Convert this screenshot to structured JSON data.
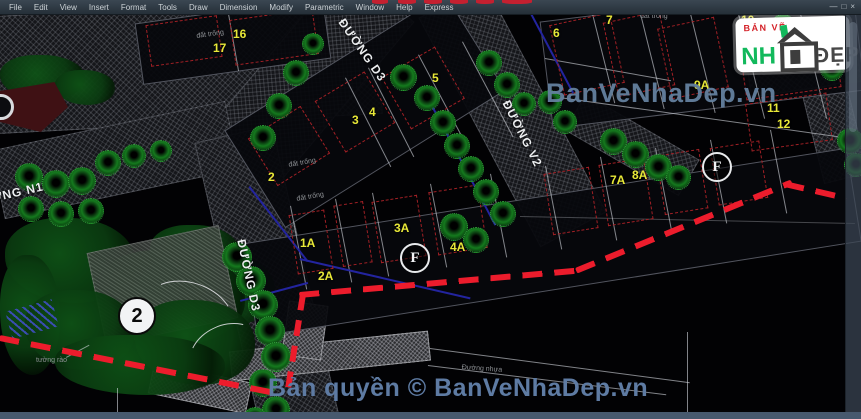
{
  "window": {
    "menu_items": [
      "File",
      "Edit",
      "View",
      "Insert",
      "Format",
      "Tools",
      "Draw",
      "Dimension",
      "Modify",
      "Parametric",
      "Window",
      "Help",
      "Express"
    ],
    "controls": [
      {
        "glyph": "—",
        "name": "minimize-button"
      },
      {
        "glyph": "□",
        "name": "restore-button"
      },
      {
        "glyph": "×",
        "name": "close-button"
      }
    ]
  },
  "logo": {
    "top": "BẢN VẼ",
    "nh": "NH",
    "dep": "ĐẸP"
  },
  "watermarks": {
    "center": "BanVeNhaDep.vn",
    "bottom": "Bản quyền © BanVeNhaDep.vn"
  },
  "colors": {
    "boundary_red": "#ec1c2c",
    "lot_label_yellow": "#e8e838",
    "tree_green": "#157a1e",
    "watermark_blue": "#64819f",
    "logo_green": "#12b95c",
    "logo_red": "#d42027",
    "menu_bg": "#2f3a44",
    "bottom_strip": "#47596e"
  },
  "scene": {
    "elements": [
      {
        "cls": "road",
        "x": -5,
        "y": 6,
        "w": 385,
        "h": 118,
        "rot": -3
      },
      {
        "cls": "road",
        "x": 258,
        "y": -35,
        "w": 90,
        "h": 240,
        "rot": 40
      },
      {
        "cls": "road",
        "x": -5,
        "y": 125,
        "w": 240,
        "h": 70,
        "rot": -12
      },
      {
        "cls": "road",
        "x": 227,
        "y": 130,
        "w": 80,
        "h": 300,
        "rot": -13
      },
      {
        "cls": "road",
        "x": 475,
        "y": -15,
        "w": 75,
        "h": 260,
        "rot": -28
      },
      {
        "cls": "road",
        "x": 745,
        "y": 12,
        "w": 112,
        "h": 78,
        "rot": -8
      },
      {
        "cls": "road",
        "x": 812,
        "y": 85,
        "w": 46,
        "h": 95,
        "rot": -14
      },
      {
        "cls": "road",
        "x": 566,
        "y": 124,
        "w": 132,
        "h": 42,
        "rot": 30
      },
      {
        "cls": "roadlight",
        "x": 230,
        "y": 341,
        "w": 200,
        "h": 30,
        "rot": -6
      },
      {
        "cls": "roadlight",
        "x": 285,
        "y": 303,
        "w": 40,
        "h": 55,
        "rot": 8
      },
      {
        "cls": "roadlight",
        "x": 150,
        "y": 372,
        "w": 100,
        "h": 32,
        "rot": 12
      },
      {
        "cls": "blob",
        "x": 5,
        "y": 218,
        "w": 130,
        "h": 85
      },
      {
        "cls": "blob",
        "x": 150,
        "y": 225,
        "w": 90,
        "h": 55
      },
      {
        "cls": "blob",
        "x": 185,
        "y": 255,
        "w": 90,
        "h": 70
      },
      {
        "cls": "blob",
        "x": 0,
        "y": 255,
        "w": 60,
        "h": 120
      },
      {
        "cls": "blob",
        "x": 95,
        "y": 250,
        "w": 150,
        "h": 95
      },
      {
        "cls": "blob",
        "x": 0,
        "y": 55,
        "w": 85,
        "h": 45
      },
      {
        "cls": "blob",
        "x": 55,
        "y": 70,
        "w": 60,
        "h": 35
      },
      {
        "cls": "patch",
        "x": 95,
        "y": 238,
        "w": 135,
        "h": 95,
        "rot": -12
      },
      {
        "cls": "blob",
        "x": 25,
        "y": 290,
        "w": 110,
        "h": 80
      },
      {
        "cls": "blob",
        "x": 135,
        "y": 300,
        "w": 120,
        "h": 85
      },
      {
        "cls": "blob",
        "x": 55,
        "y": 335,
        "w": 170,
        "h": 60
      },
      {
        "cls": "stripes",
        "x": 8,
        "y": 305,
        "w": 48,
        "h": 28,
        "rot": -15
      },
      {
        "cls": "arc",
        "x": 140,
        "y": 282,
        "w": 95,
        "h": 70,
        "rot": 18
      },
      {
        "cls": "arc",
        "x": 188,
        "y": 325,
        "w": 75,
        "h": 55,
        "rot": -25
      },
      {
        "cls": "wedge",
        "x": 0,
        "y": 82,
        "w": 68,
        "h": 50
      },
      {
        "cls": "circ",
        "x": -12,
        "y": 94,
        "d": 26
      },
      {
        "cls": "lot",
        "x": 138,
        "y": 10,
        "w": 190,
        "h": 62,
        "rot": -8
      },
      {
        "cls": "lot",
        "x": 235,
        "y": 53,
        "w": 260,
        "h": 115,
        "rot": -32
      },
      {
        "cls": "lot",
        "x": 545,
        "y": 2,
        "w": 315,
        "h": 108,
        "rot": -7
      },
      {
        "cls": "lot",
        "x": 246,
        "y": 195,
        "w": 612,
        "h": 95,
        "rot": -9
      },
      {
        "cls": "line",
        "x": 228,
        "y": 14,
        "w": 1,
        "h": 58,
        "rot": -10
      },
      {
        "cls": "line",
        "x": 345,
        "y": 78,
        "w": 1,
        "h": 100,
        "rot": -27
      },
      {
        "cls": "line",
        "x": 368,
        "y": 68,
        "w": 1,
        "h": 100,
        "rot": -27
      },
      {
        "cls": "line",
        "x": 418,
        "y": 55,
        "w": 1,
        "h": 105,
        "rot": -28
      },
      {
        "cls": "line",
        "x": 462,
        "y": 42,
        "w": 1,
        "h": 108,
        "rot": -28
      },
      {
        "cls": "line",
        "x": 592,
        "y": 14,
        "w": 1,
        "h": 92,
        "rot": -14
      },
      {
        "cls": "line",
        "x": 640,
        "y": 14,
        "w": 1,
        "h": 98,
        "rot": -14
      },
      {
        "cls": "line",
        "x": 690,
        "y": 14,
        "w": 1,
        "h": 102,
        "rot": -14
      },
      {
        "cls": "line",
        "x": 738,
        "y": 14,
        "w": 1,
        "h": 108,
        "rot": -14
      },
      {
        "cls": "line",
        "x": 800,
        "y": 14,
        "w": 1,
        "h": 108,
        "rot": -14
      },
      {
        "cls": "line",
        "x": 552,
        "y": 96,
        "w": 308,
        "h": 1,
        "rot": 8
      },
      {
        "cls": "line",
        "x": 545,
        "y": 58,
        "w": 128,
        "h": 1,
        "rot": 10
      },
      {
        "cls": "line",
        "x": 290,
        "y": 206,
        "w": 1,
        "h": 85,
        "rot": -11
      },
      {
        "cls": "line",
        "x": 335,
        "y": 199,
        "w": 1,
        "h": 85,
        "rot": -11
      },
      {
        "cls": "line",
        "x": 372,
        "y": 193,
        "w": 1,
        "h": 85,
        "rot": -11
      },
      {
        "cls": "line",
        "x": 430,
        "y": 184,
        "w": 1,
        "h": 85,
        "rot": -11
      },
      {
        "cls": "line",
        "x": 490,
        "y": 174,
        "w": 1,
        "h": 85,
        "rot": -11
      },
      {
        "cls": "line",
        "x": 545,
        "y": 166,
        "w": 1,
        "h": 85,
        "rot": -11
      },
      {
        "cls": "line",
        "x": 600,
        "y": 157,
        "w": 1,
        "h": 85,
        "rot": -11
      },
      {
        "cls": "line",
        "x": 655,
        "y": 148,
        "w": 1,
        "h": 85,
        "rot": -11
      },
      {
        "cls": "line",
        "x": 710,
        "y": 140,
        "w": 1,
        "h": 85,
        "rot": -11
      },
      {
        "cls": "line",
        "x": 770,
        "y": 130,
        "w": 1,
        "h": 85,
        "rot": -11
      },
      {
        "cls": "line",
        "x": 430,
        "y": 348,
        "w": 262,
        "h": 1,
        "rot": 7.5
      },
      {
        "cls": "line",
        "x": 428,
        "y": 365,
        "w": 240,
        "h": 1,
        "rot": 7
      },
      {
        "cls": "line",
        "x": 117,
        "y": 388,
        "w": 1,
        "h": 31
      },
      {
        "cls": "line",
        "x": 687,
        "y": 332,
        "w": 1,
        "h": 82
      },
      {
        "cls": "fline",
        "x": 520,
        "y": 216,
        "w": 335,
        "h": 1,
        "rot": 1.2
      },
      {
        "cls": "line",
        "x": 66,
        "y": 357,
        "w": 26,
        "h": 1,
        "rot": -28
      },
      {
        "cls": "bline",
        "x": 250,
        "y": 186,
        "w": 95,
        "h": 2,
        "rot": 52
      },
      {
        "cls": "bline",
        "x": 300,
        "y": 258,
        "w": 175,
        "h": 2,
        "rot": 13
      },
      {
        "cls": "bline",
        "x": 425,
        "y": 95,
        "w": 2,
        "h": 148,
        "rot": -28
      },
      {
        "cls": "bline",
        "x": 530,
        "y": 14,
        "w": 2,
        "h": 90,
        "rot": -28
      },
      {
        "cls": "bline",
        "x": 240,
        "y": 300,
        "w": 70,
        "h": 2,
        "rot": -15
      },
      {
        "cls": "rd",
        "x": 148,
        "y": 20,
        "w": 72,
        "h": 42,
        "rot": -8
      },
      {
        "cls": "rd",
        "x": 232,
        "y": 14,
        "w": 84,
        "h": 46,
        "rot": -8
      },
      {
        "cls": "rd",
        "x": 258,
        "y": 118,
        "w": 62,
        "h": 56,
        "rot": -32
      },
      {
        "cls": "rd",
        "x": 326,
        "y": 82,
        "w": 58,
        "h": 60,
        "rot": -31
      },
      {
        "cls": "rd",
        "x": 392,
        "y": 58,
        "w": 62,
        "h": 60,
        "rot": -30
      },
      {
        "cls": "rd",
        "x": 556,
        "y": 18,
        "w": 62,
        "h": 72,
        "rot": -12
      },
      {
        "cls": "rd",
        "x": 610,
        "y": 16,
        "w": 58,
        "h": 76,
        "rot": -12
      },
      {
        "cls": "rd",
        "x": 664,
        "y": 22,
        "w": 58,
        "h": 72,
        "rot": -12
      },
      {
        "cls": "rd",
        "x": 742,
        "y": 36,
        "w": 96,
        "h": 58,
        "rot": -8
      },
      {
        "cls": "rd",
        "x": 748,
        "y": 98,
        "w": 82,
        "h": 48,
        "rot": -8
      },
      {
        "cls": "rd",
        "x": 293,
        "y": 212,
        "w": 36,
        "h": 60,
        "rot": -9
      },
      {
        "cls": "rd",
        "x": 338,
        "y": 203,
        "w": 30,
        "h": 62,
        "rot": -9
      },
      {
        "cls": "rd",
        "x": 376,
        "y": 198,
        "w": 46,
        "h": 62,
        "rot": -9
      },
      {
        "cls": "rd",
        "x": 433,
        "y": 188,
        "w": 50,
        "h": 64,
        "rot": -9
      },
      {
        "cls": "rd",
        "x": 548,
        "y": 170,
        "w": 46,
        "h": 62,
        "rot": -9
      },
      {
        "cls": "rd",
        "x": 603,
        "y": 161,
        "w": 46,
        "h": 62,
        "rot": -9
      },
      {
        "cls": "rd",
        "x": 660,
        "y": 152,
        "w": 44,
        "h": 60,
        "rot": -9
      },
      {
        "cls": "rd",
        "x": 714,
        "y": 144,
        "w": 50,
        "h": 58,
        "rot": -9
      },
      {
        "cls": "tree",
        "x": 283,
        "y": 60,
        "d": 26
      },
      {
        "cls": "tree",
        "x": 266,
        "y": 93,
        "d": 26
      },
      {
        "cls": "tree",
        "x": 250,
        "y": 125,
        "d": 26
      },
      {
        "cls": "tree",
        "x": 302,
        "y": 33,
        "d": 22
      },
      {
        "cls": "tree",
        "x": 390,
        "y": 64,
        "d": 27
      },
      {
        "cls": "tree",
        "x": 414,
        "y": 85,
        "d": 26
      },
      {
        "cls": "tree",
        "x": 430,
        "y": 110,
        "d": 26
      },
      {
        "cls": "tree",
        "x": 444,
        "y": 133,
        "d": 26
      },
      {
        "cls": "tree",
        "x": 458,
        "y": 156,
        "d": 26
      },
      {
        "cls": "tree",
        "x": 473,
        "y": 179,
        "d": 26
      },
      {
        "cls": "tree",
        "x": 490,
        "y": 201,
        "d": 26
      },
      {
        "cls": "tree",
        "x": 440,
        "y": 213,
        "d": 28
      },
      {
        "cls": "tree",
        "x": 463,
        "y": 227,
        "d": 26
      },
      {
        "cls": "tree",
        "x": 476,
        "y": 50,
        "d": 26
      },
      {
        "cls": "tree",
        "x": 494,
        "y": 72,
        "d": 26
      },
      {
        "cls": "tree",
        "x": 512,
        "y": 92,
        "d": 24
      },
      {
        "cls": "tree",
        "x": 538,
        "y": 90,
        "d": 24
      },
      {
        "cls": "tree",
        "x": 553,
        "y": 110,
        "d": 24
      },
      {
        "cls": "tree",
        "x": 600,
        "y": 128,
        "d": 27
      },
      {
        "cls": "tree",
        "x": 622,
        "y": 141,
        "d": 27
      },
      {
        "cls": "tree",
        "x": 645,
        "y": 154,
        "d": 27
      },
      {
        "cls": "tree",
        "x": 666,
        "y": 165,
        "d": 25
      },
      {
        "cls": "tree",
        "x": 770,
        "y": 14,
        "d": 26
      },
      {
        "cls": "tree",
        "x": 796,
        "y": 37,
        "d": 26
      },
      {
        "cls": "tree",
        "x": 820,
        "y": 57,
        "d": 24
      },
      {
        "cls": "tree",
        "x": 837,
        "y": 128,
        "d": 26
      },
      {
        "cls": "tree",
        "x": 844,
        "y": 153,
        "d": 24
      },
      {
        "cls": "tree",
        "x": 15,
        "y": 163,
        "d": 28
      },
      {
        "cls": "tree",
        "x": 42,
        "y": 170,
        "d": 28
      },
      {
        "cls": "tree",
        "x": 68,
        "y": 167,
        "d": 28
      },
      {
        "cls": "tree",
        "x": 95,
        "y": 150,
        "d": 26
      },
      {
        "cls": "tree",
        "x": 122,
        "y": 144,
        "d": 24
      },
      {
        "cls": "tree",
        "x": 150,
        "y": 140,
        "d": 22
      },
      {
        "cls": "tree",
        "x": 18,
        "y": 196,
        "d": 26
      },
      {
        "cls": "tree",
        "x": 48,
        "y": 201,
        "d": 26
      },
      {
        "cls": "tree",
        "x": 78,
        "y": 198,
        "d": 26
      },
      {
        "cls": "tree",
        "x": 222,
        "y": 242,
        "d": 30
      },
      {
        "cls": "tree",
        "x": 236,
        "y": 266,
        "d": 30
      },
      {
        "cls": "tree",
        "x": 248,
        "y": 290,
        "d": 30
      },
      {
        "cls": "tree",
        "x": 255,
        "y": 316,
        "d": 30
      },
      {
        "cls": "tree",
        "x": 261,
        "y": 342,
        "d": 30
      },
      {
        "cls": "tree",
        "x": 249,
        "y": 369,
        "d": 28
      },
      {
        "cls": "tree",
        "x": 262,
        "y": 396,
        "d": 28
      },
      {
        "cls": "tree",
        "x": 243,
        "y": 407,
        "d": 24
      },
      {
        "cls": "rdash",
        "x": 0,
        "y": 335,
        "w": 282,
        "h": 6,
        "rot": 11.3
      },
      {
        "cls": "rdashv",
        "x": 300,
        "y": 294,
        "w": 6,
        "h": 100,
        "rot": 9
      },
      {
        "cls": "rdash",
        "x": 299,
        "y": 292,
        "w": 280,
        "h": 6,
        "rot": -5
      },
      {
        "cls": "rdash",
        "x": 575,
        "y": 268,
        "w": 233,
        "h": 6,
        "rot": -22.3
      },
      {
        "cls": "rdash",
        "x": 785,
        "y": 181,
        "w": 64,
        "h": 6,
        "rot": 13
      },
      {
        "cls": "redfrag",
        "x": 372,
        "y": 0,
        "w": 16,
        "h": 4
      },
      {
        "cls": "redfrag",
        "x": 398,
        "y": 0,
        "w": 18,
        "h": 4
      },
      {
        "cls": "redfrag",
        "x": 424,
        "y": 0,
        "w": 18,
        "h": 4
      },
      {
        "cls": "redfrag",
        "x": 450,
        "y": 0,
        "w": 18,
        "h": 4
      },
      {
        "cls": "redfrag",
        "x": 476,
        "y": 0,
        "w": 18,
        "h": 4
      },
      {
        "cls": "redfrag",
        "x": 502,
        "y": 0,
        "w": 30,
        "h": 4
      },
      {
        "cls": "street",
        "text": "ĐƯỜNG D3",
        "x": 347,
        "y": 16,
        "rot": 55
      },
      {
        "cls": "street",
        "text": "ĐƯỜNG N1",
        "x": -30,
        "y": 196,
        "rot": -13
      },
      {
        "cls": "street",
        "text": "ĐƯỜNG V2",
        "x": 512,
        "y": 98,
        "rot": 63
      },
      {
        "cls": "street",
        "text": "ĐƯỜNG D3",
        "x": 248,
        "y": 238,
        "rot": 78
      },
      {
        "cls": "lotnum",
        "text": "17",
        "x": 213,
        "y": 41
      },
      {
        "cls": "lotnum",
        "text": "16",
        "x": 233,
        "y": 27
      },
      {
        "cls": "lotnum",
        "text": "2",
        "x": 268,
        "y": 170
      },
      {
        "cls": "lotnum",
        "text": "3",
        "x": 352,
        "y": 113
      },
      {
        "cls": "lotnum",
        "text": "4",
        "x": 369,
        "y": 105
      },
      {
        "cls": "lotnum",
        "text": "5",
        "x": 432,
        "y": 71
      },
      {
        "cls": "lotnum",
        "text": "6",
        "x": 553,
        "y": 26
      },
      {
        "cls": "lotnum",
        "text": "7",
        "x": 606,
        "y": 13
      },
      {
        "cls": "lotnum",
        "text": "10",
        "x": 741,
        "y": 13
      },
      {
        "cls": "lotnum",
        "text": "9A",
        "x": 694,
        "y": 78
      },
      {
        "cls": "lotnum",
        "text": "11",
        "x": 767,
        "y": 101
      },
      {
        "cls": "lotnum",
        "text": "12",
        "x": 777,
        "y": 117
      },
      {
        "cls": "lotnum",
        "text": "1A",
        "x": 300,
        "y": 236
      },
      {
        "cls": "lotnum",
        "text": "2A",
        "x": 318,
        "y": 269
      },
      {
        "cls": "lotnum",
        "text": "3A",
        "x": 394,
        "y": 221
      },
      {
        "cls": "lotnum",
        "text": "4A",
        "x": 450,
        "y": 240
      },
      {
        "cls": "lotnum",
        "text": "7A",
        "x": 610,
        "y": 173
      },
      {
        "cls": "lotnum",
        "text": "8A",
        "x": 632,
        "y": 168
      },
      {
        "cls": "circF",
        "text": "F",
        "x": 400,
        "y": 243,
        "d": 30
      },
      {
        "cls": "circF",
        "text": "F",
        "x": 702,
        "y": 152,
        "d": 30
      },
      {
        "cls": "circW",
        "text": "2",
        "x": 118,
        "y": 297,
        "d": 38
      },
      {
        "cls": "tiny",
        "text": "đất trống",
        "x": 196,
        "y": 33,
        "rot": -8
      },
      {
        "cls": "tiny",
        "text": "đất trống",
        "x": 288,
        "y": 162,
        "rot": -10
      },
      {
        "cls": "tiny",
        "text": "đất trống",
        "x": 296,
        "y": 196,
        "rot": -10
      },
      {
        "cls": "tiny",
        "text": "đất trống",
        "x": 640,
        "y": 13
      },
      {
        "cls": "tiny",
        "text": "Đường nhựa",
        "x": 462,
        "y": 364,
        "rot": 4
      },
      {
        "cls": "tiny",
        "text": "tường rào",
        "x": 36,
        "y": 357
      },
      {
        "cls": "tiny",
        "text": "8",
        "x": 830,
        "y": 64
      }
    ]
  }
}
